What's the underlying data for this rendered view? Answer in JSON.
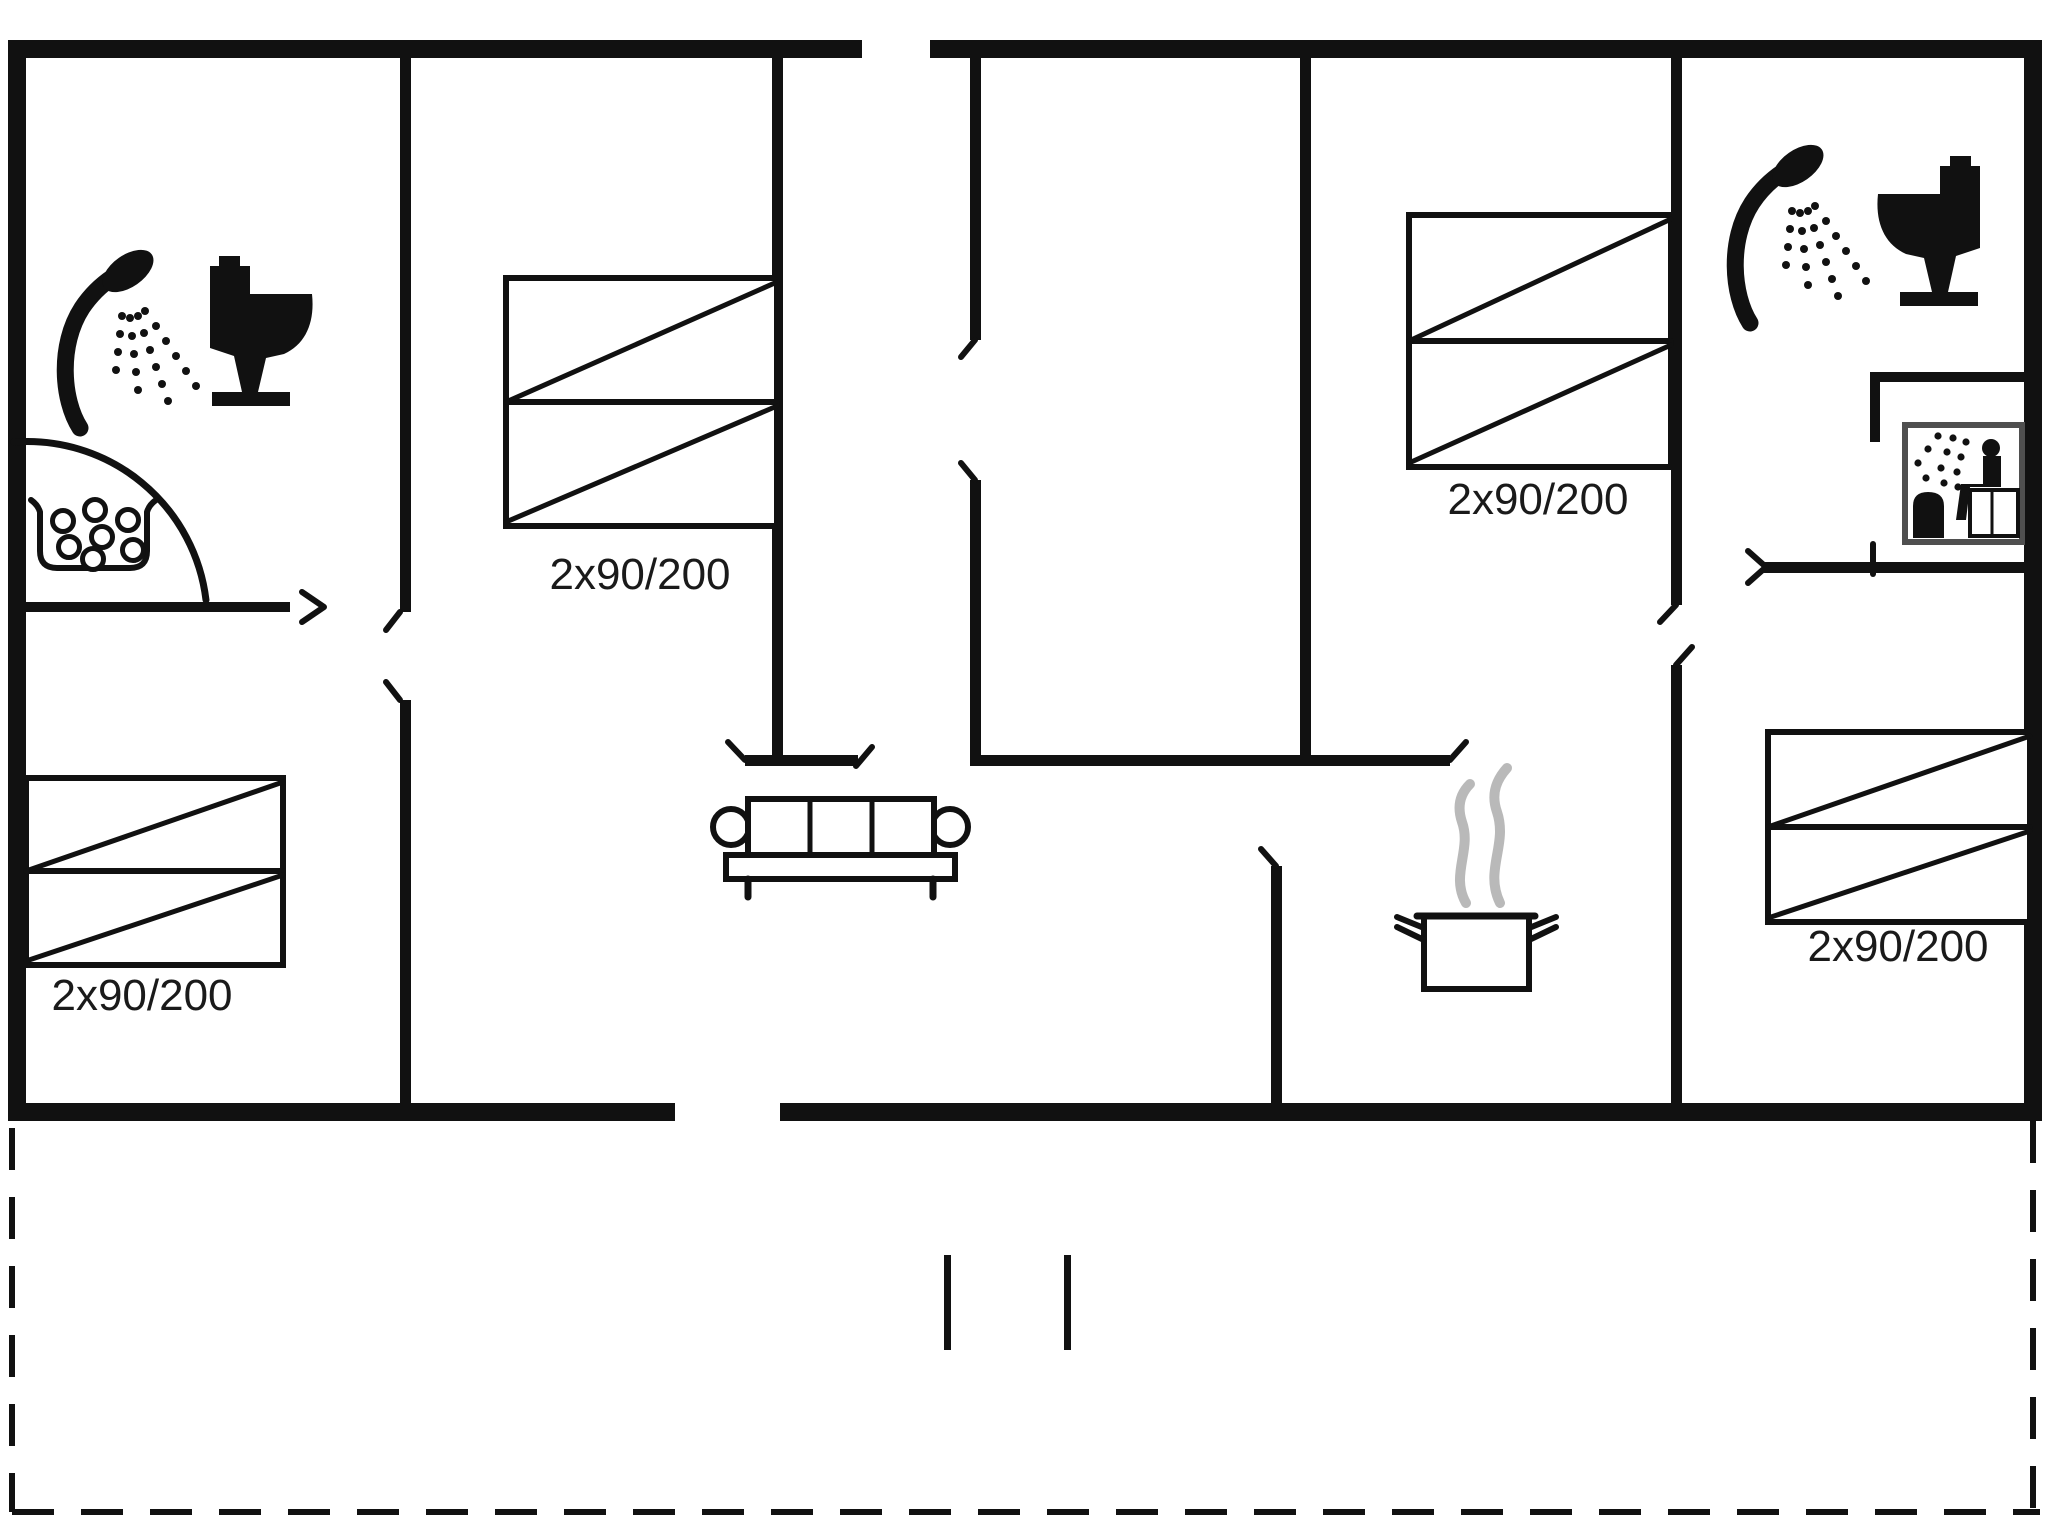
{
  "title": "Holiday home floor plan",
  "colors": {
    "background": "#ffffff",
    "walls": "#111111",
    "steam": "#b9b9b9",
    "sauna_frame": "#4f4f4f",
    "label_text": "#1a1a1a"
  },
  "beds": [
    {
      "id": "bed-top-left",
      "label": "2x90/200"
    },
    {
      "id": "bed-top-right",
      "label": "2x90/200"
    },
    {
      "id": "bed-bottom-left",
      "label": "2x90/200"
    },
    {
      "id": "bed-bottom-right",
      "label": "2x90/200"
    }
  ],
  "icons": [
    "shower-icon",
    "toilet-icon",
    "whirlpool-icon",
    "sauna-icon",
    "sofa-icon",
    "cooking-pot-icon",
    "steam-icon",
    "door-swing-arc",
    "terrace-boundary-dashed",
    "terrace-step-marks"
  ]
}
